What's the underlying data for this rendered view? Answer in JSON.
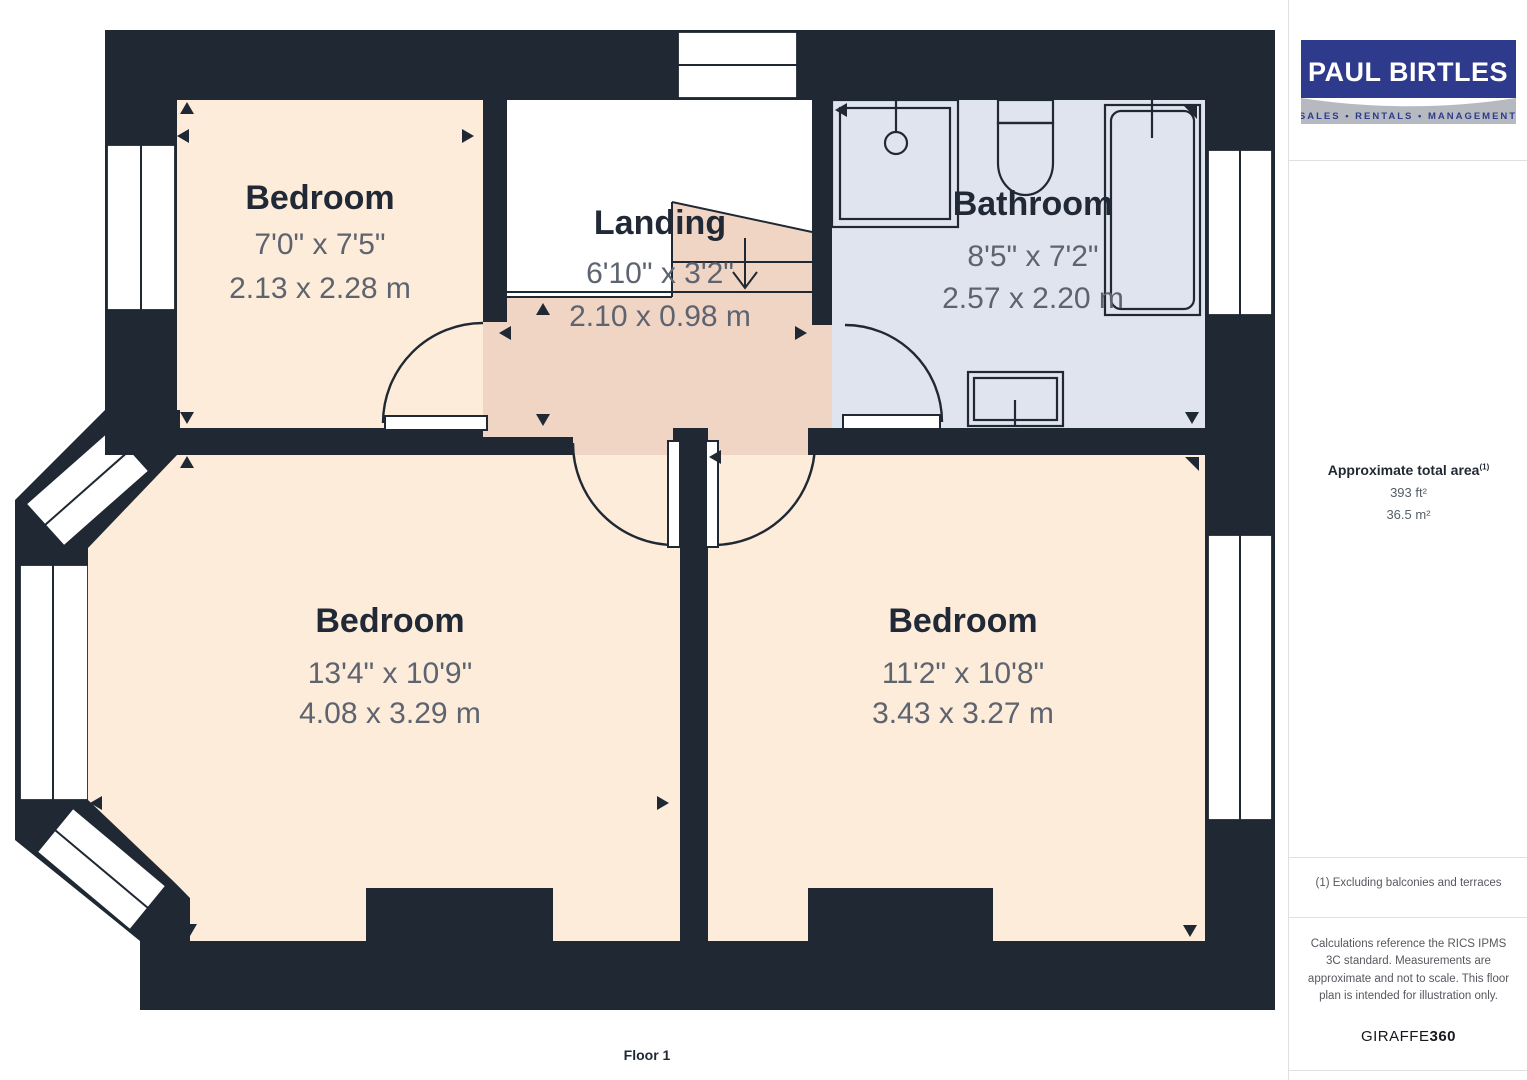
{
  "plan": {
    "floor_label": "Floor 1",
    "rooms": {
      "bedroom_tl": {
        "name": "Bedroom",
        "imperial": "7'0\" x 7'5\"",
        "metric": "2.13 x 2.28 m"
      },
      "landing": {
        "name": "Landing",
        "imperial": "6'10\" x 3'2\"",
        "metric": "2.10 x 0.98 m"
      },
      "bathroom": {
        "name": "Bathroom",
        "imperial": "8'5\" x 7'2\"",
        "metric": "2.57 x 2.20 m"
      },
      "bedroom_bl": {
        "name": "Bedroom",
        "imperial": "13'4\" x 10'9\"",
        "metric": "4.08 x 3.29 m"
      },
      "bedroom_br": {
        "name": "Bedroom",
        "imperial": "11'2\" x 10'8\"",
        "metric": "3.43 x 3.27 m"
      }
    }
  },
  "sidebar": {
    "logo": {
      "title": "PAUL BIRTLES",
      "tagline": "SALES • RENTALS • MANAGEMENT"
    },
    "area": {
      "title": "Approximate total area",
      "superscript": "(1)",
      "imperial": "393 ft²",
      "metric": "36.5 m²"
    },
    "footnote": "(1) Excluding balconies and terraces",
    "disclaimer": "Calculations reference the RICS IPMS 3C standard. Measurements are approximate and not to scale. This floor plan is intended for illustration only.",
    "brand": {
      "name": "GIRAFFE",
      "suffix": "360"
    }
  },
  "colors": {
    "wall": "#1f2833",
    "bedroom_fill": "#fdecd9",
    "landing_fill": "#f0d5c5",
    "bathroom_fill": "#e0e4ef",
    "dim_text": "#5d6470",
    "logo_blue": "#2e3a8c",
    "logo_gray": "#b6bac0"
  }
}
